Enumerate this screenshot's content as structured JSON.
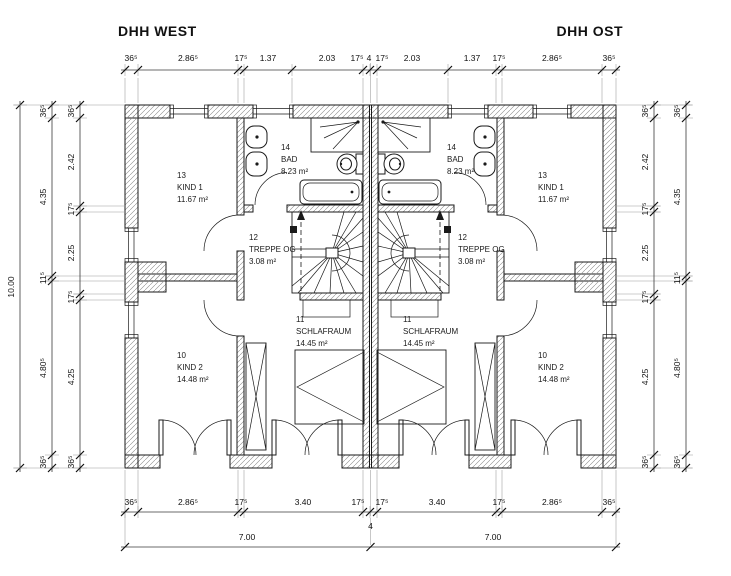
{
  "titles": {
    "west": "DHH WEST",
    "ost": "DHH OST"
  },
  "dimensions": {
    "top": [
      "36⁵",
      "2.86⁵",
      "17⁵",
      "1.37",
      "2.03",
      "17⁵",
      "4",
      "17⁵",
      "2.03",
      "1.37",
      "17⁵",
      "2.86⁵",
      "36⁵"
    ],
    "bottom": [
      "36⁵",
      "2.86⁵",
      "17⁵",
      "3.40",
      "17⁵",
      "4",
      "17⁵",
      "3.40",
      "17⁵",
      "2.86⁵",
      "36⁵"
    ],
    "bottom_totals": [
      "7.00",
      "7.00"
    ],
    "left_total": "10.00",
    "left_outer": [
      "36⁵",
      "4.35",
      "11⁵",
      "4.80⁵",
      "36⁵"
    ],
    "left_inner": [
      "36⁵",
      "2.42",
      "17⁵",
      "2.25",
      "17⁵",
      "4.25",
      "36⁵"
    ],
    "right_inner": [
      "36⁵",
      "2.42",
      "17⁵",
      "2.25",
      "17⁵",
      "4.25",
      "36⁵"
    ],
    "right_outer": [
      "36⁵",
      "4.35",
      "11⁵",
      "4.80⁵",
      "36⁵"
    ]
  },
  "rooms": {
    "west": {
      "kind1": {
        "number": "13",
        "name": "KIND 1",
        "area": "11.67 m²"
      },
      "bad": {
        "number": "14",
        "name": "BAD",
        "area": "8.23 m²"
      },
      "treppe": {
        "number": "12",
        "name": "TREPPE OG",
        "area": "3.08 m²"
      },
      "schlafraum": {
        "number": "11",
        "name": "SCHLAFRAUM",
        "area": "14.45 m²"
      },
      "kind2": {
        "number": "10",
        "name": "KIND 2",
        "area": "14.48 m²"
      }
    },
    "ost": {
      "kind1": {
        "number": "13",
        "name": "KIND 1",
        "area": "11.67 m²"
      },
      "bad": {
        "number": "14",
        "name": "BAD",
        "area": "8.23 m²"
      },
      "treppe": {
        "number": "12",
        "name": "TREPPE OG",
        "area": "3.08 m²"
      },
      "schlafraum": {
        "number": "11",
        "name": "SCHLAFRAUM",
        "area": "14.45 m²"
      },
      "kind2": {
        "number": "10",
        "name": "KIND 2",
        "area": "14.48 m²"
      }
    }
  }
}
